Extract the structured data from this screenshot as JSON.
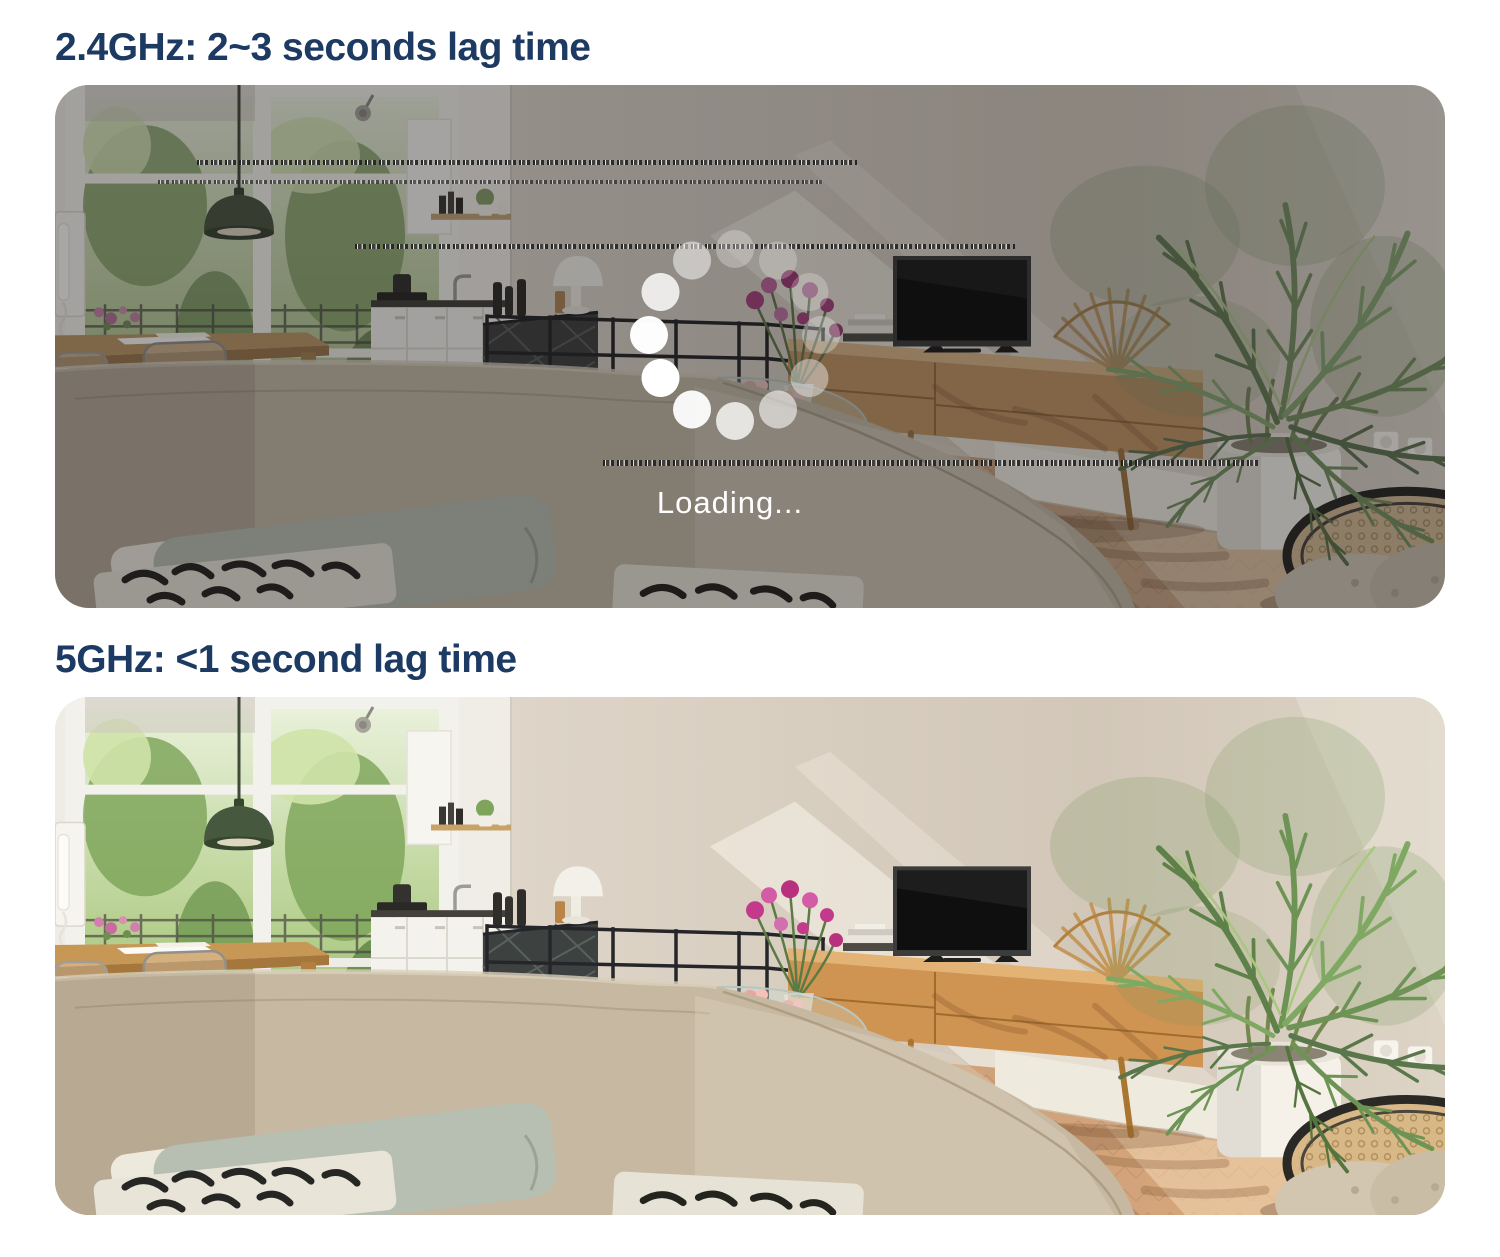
{
  "page": {
    "background": "#ffffff",
    "heading_color": "#1d3a63"
  },
  "panels": [
    {
      "id": "2-4ghz",
      "heading": "2.4GHz: 2~3 seconds lag time",
      "state": "loading",
      "loading": {
        "label": "Loading...",
        "dots": 12
      },
      "artifacts": "glitch-static-lines"
    },
    {
      "id": "5ghz",
      "heading": "5GHz: <1 second lag time",
      "state": "live"
    }
  ],
  "colors": {
    "loading_text": "#ffffff",
    "spinner_dot": "#ffffff",
    "wall": "#d2c7b8",
    "floor_warm": "#dca97c",
    "plant_green": "#6d9355"
  }
}
